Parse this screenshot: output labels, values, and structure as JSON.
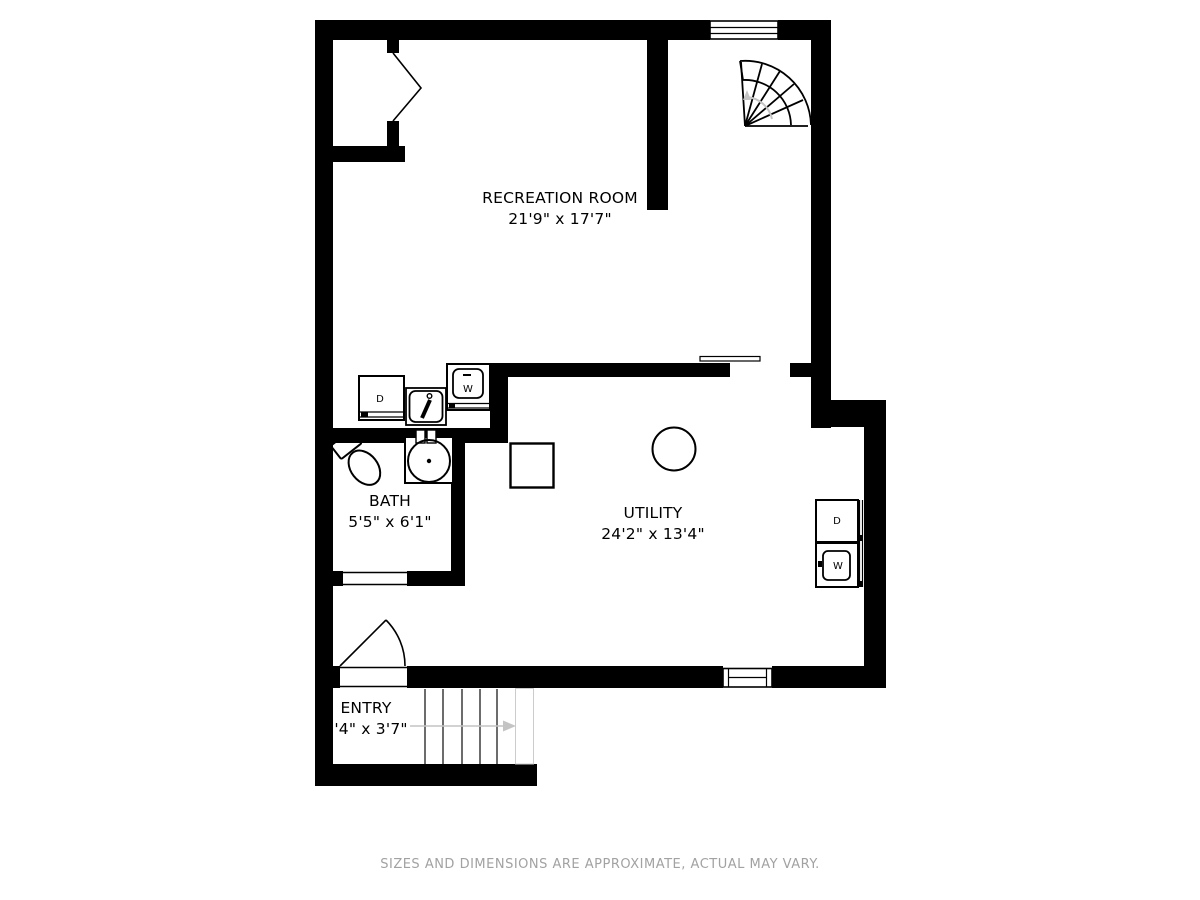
{
  "rooms": [
    {
      "name": "RECREATION ROOM",
      "dims": "21'9\" x 17'7\""
    },
    {
      "name": "BATH",
      "dims": "5'5\" x 6'1\""
    },
    {
      "name": "UTILITY",
      "dims": "24'2\" x 13'4\""
    },
    {
      "name": "ENTRY",
      "dims": "3'4\" x 3'7\""
    }
  ],
  "appliances": {
    "laundry_dryer": "D",
    "laundry_washer": "W",
    "utility_dryer": "D",
    "utility_washer": "W"
  },
  "footer": "SIZES AND DIMENSIONS ARE APPROXIMATE, ACTUAL MAY VARY.",
  "colors": {
    "wall": "#000000",
    "line": "#000000",
    "muted": "#a2a2a2",
    "stair_arrow": "#c4c4c4"
  }
}
